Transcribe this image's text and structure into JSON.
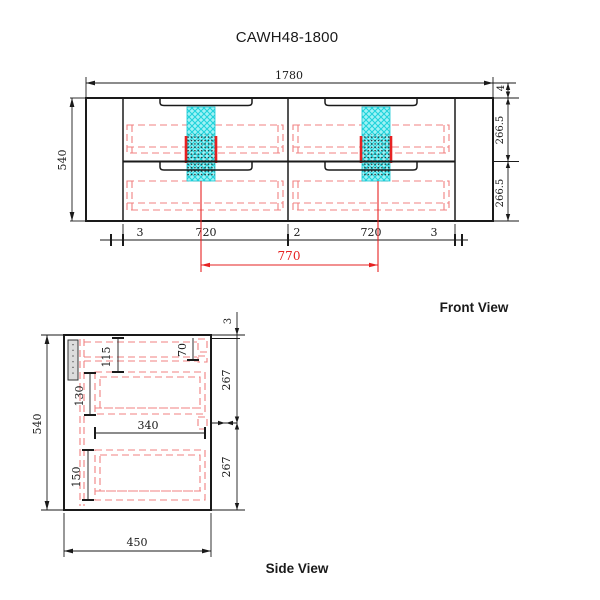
{
  "title": "CAWH48-1800",
  "front_view": {
    "label": "Front View",
    "dims": {
      "overall_width": "1780",
      "top_gap": "4",
      "overall_height": "540",
      "upper_front_height": "266.5",
      "lower_front_height": "266.5",
      "left_gap": "3",
      "left_front_width": "720",
      "center_gap": "2",
      "right_front_width": "720",
      "right_gap": "3",
      "bracket_centers": "770"
    }
  },
  "side_view": {
    "label": "Side View",
    "dims": {
      "overall_height": "540",
      "overall_depth": "450",
      "top_gap": "3",
      "upper_front_height": "267",
      "lower_front_height": "267",
      "top_to_rail": "70",
      "top_to_drawer_box": "115",
      "upper_box_height": "130",
      "lower_box_height": "150",
      "internal_depth": "340"
    }
  },
  "colors": {
    "highlight_fill": "#9ff2f5",
    "highlight_hatch": "#1fd3db",
    "hidden_line_red": "#f08080",
    "dimension_red": "#e62222",
    "bracket_gray": "#dcdcdc",
    "line_black": "#1a1a1a"
  }
}
